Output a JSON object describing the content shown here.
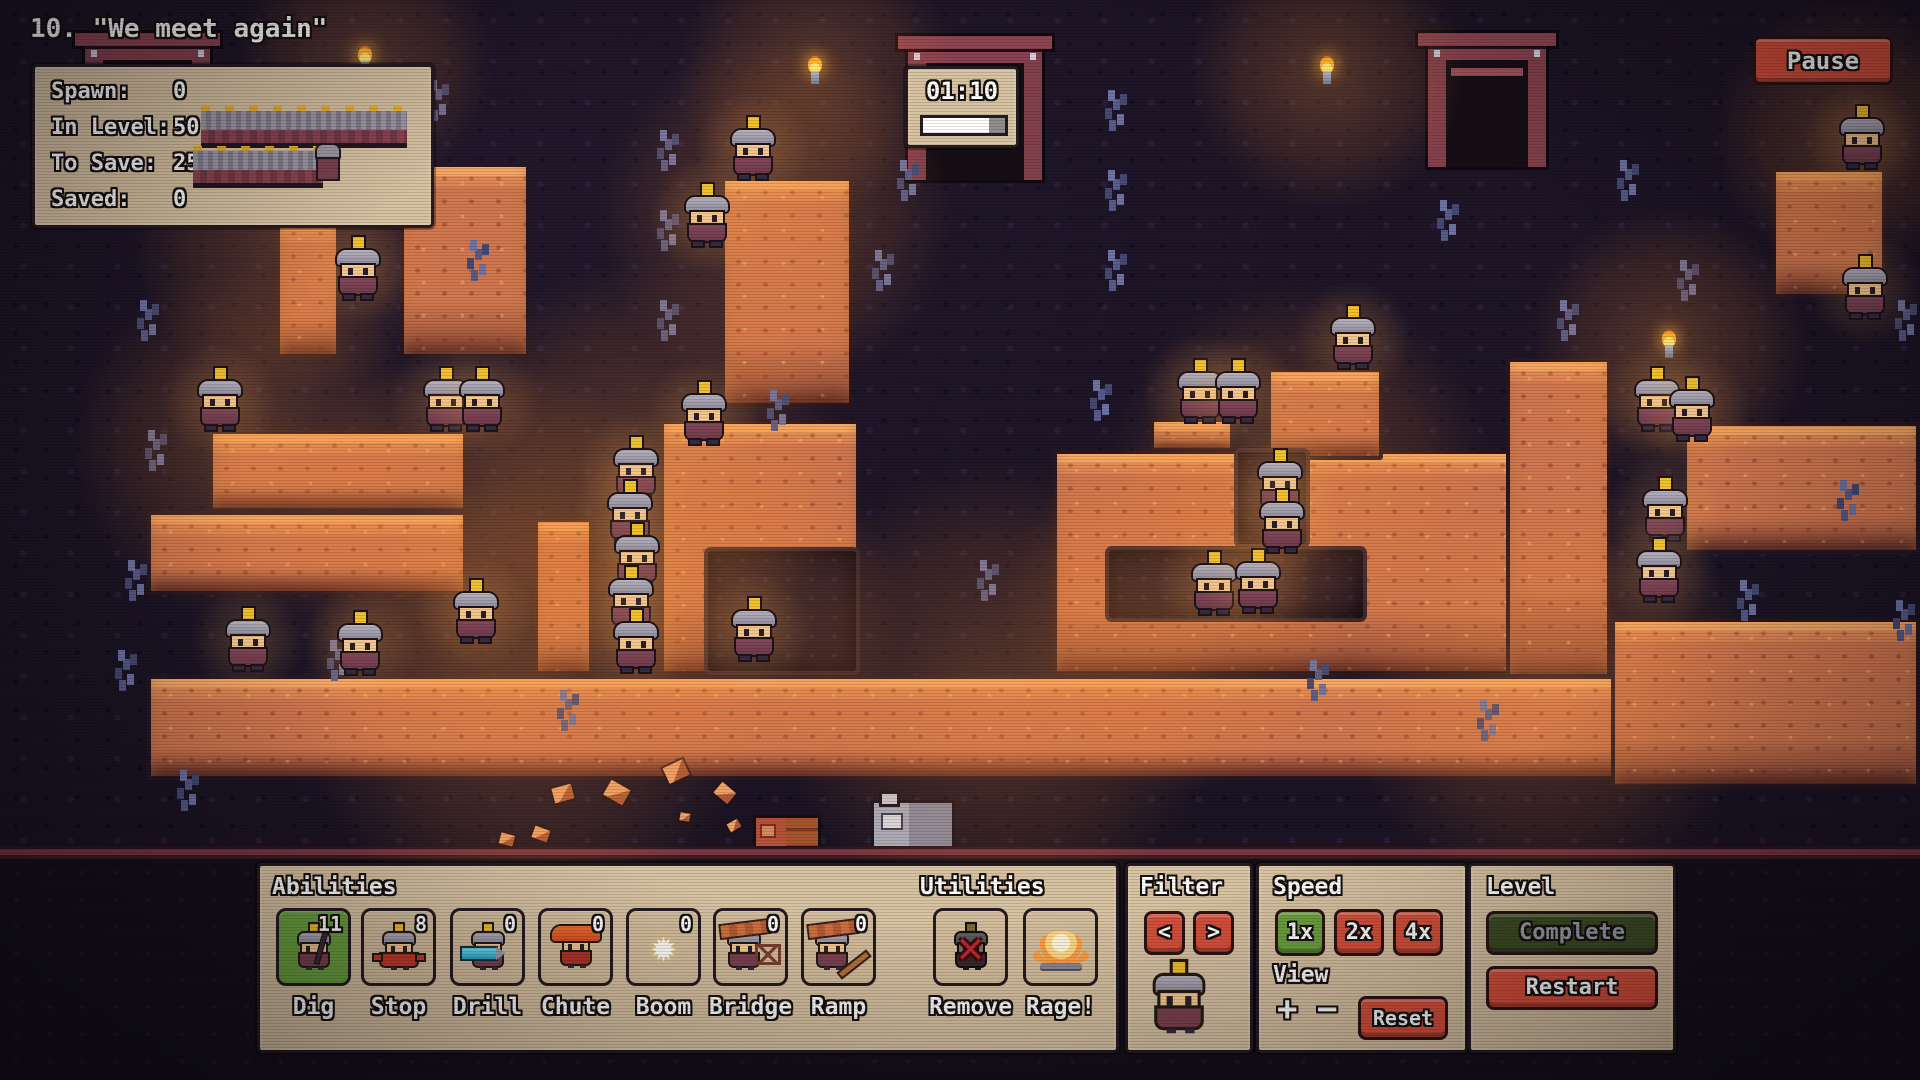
{
  "hud": {
    "title": "10. \"We meet again\"",
    "stats": {
      "rows": [
        {
          "label": "Spawn:",
          "value": "0"
        },
        {
          "label": "In Level:",
          "value": "50"
        },
        {
          "label": "To Save:",
          "value": "25"
        },
        {
          "label": "Saved:",
          "value": "0"
        }
      ]
    },
    "timer": {
      "time": "01:10",
      "progress_percent": 80
    },
    "pause_label": "Pause"
  },
  "icons": {
    "boom_star": "✹",
    "remove_x": "✕",
    "zoom_in": "+",
    "zoom_out": "−",
    "filter_prev": "<",
    "filter_next": ">"
  },
  "toolbar": {
    "abilities": {
      "header": "Abilities",
      "buttons": [
        {
          "label": "Dig",
          "count": "11",
          "selected": true
        },
        {
          "label": "Stop",
          "count": "8",
          "selected": false
        },
        {
          "label": "Drill",
          "count": "0",
          "selected": false
        },
        {
          "label": "Chute",
          "count": "0",
          "selected": false
        },
        {
          "label": "Boom",
          "count": "0",
          "selected": false
        },
        {
          "label": "Bridge",
          "count": "0",
          "selected": false
        },
        {
          "label": "Ramp",
          "count": "0",
          "selected": false
        }
      ]
    },
    "utilities": {
      "header": "Utilities",
      "buttons": [
        {
          "label": "Remove"
        },
        {
          "label": "Rage!"
        }
      ]
    },
    "filter": {
      "header": "Filter"
    },
    "speed": {
      "header": "Speed",
      "options": [
        {
          "label": "1x",
          "selected": true
        },
        {
          "label": "2x",
          "selected": false
        },
        {
          "label": "4x",
          "selected": false
        }
      ],
      "view_header": "View",
      "reset": "Reset"
    },
    "level": {
      "header": "Level",
      "complete": "Complete",
      "restart": "Restart"
    }
  },
  "colors": {
    "panel_tan": "#d7c2a2",
    "button_red": "#d7503b",
    "selected_green": "#6ba13e",
    "complete_green": "#3c4c23",
    "terrain_orange": "#d1774f",
    "cave_dark": "#1a1322",
    "timer_bar_fill": "#ffffff"
  },
  "scene": {
    "terrain": [
      [
        276,
        218,
        64,
        140
      ],
      [
        400,
        163,
        130,
        195
      ],
      [
        721,
        177,
        132,
        230
      ],
      [
        209,
        430,
        258,
        82
      ],
      [
        147,
        511,
        320,
        84
      ],
      [
        534,
        518,
        59,
        157
      ],
      [
        660,
        420,
        200,
        255
      ],
      [
        147,
        675,
        1553,
        105
      ],
      [
        1053,
        450,
        558,
        225
      ],
      [
        1267,
        368,
        116,
        92
      ],
      [
        1150,
        418,
        84,
        34
      ],
      [
        1506,
        358,
        105,
        320
      ],
      [
        1683,
        422,
        237,
        132
      ],
      [
        1611,
        618,
        309,
        170
      ],
      [
        1772,
        168,
        114,
        130
      ]
    ],
    "holes": [
      [
        1234,
        448,
        76,
        100
      ],
      [
        1105,
        546,
        262,
        76
      ],
      [
        704,
        547,
        156,
        128
      ]
    ],
    "miners": [
      [
        334,
        237
      ],
      [
        683,
        184
      ],
      [
        729,
        117
      ],
      [
        196,
        368
      ],
      [
        422,
        368
      ],
      [
        458,
        368
      ],
      [
        680,
        382
      ],
      [
        612,
        437
      ],
      [
        606,
        481
      ],
      [
        613,
        524
      ],
      [
        607,
        567
      ],
      [
        612,
        610
      ],
      [
        730,
        598
      ],
      [
        224,
        608
      ],
      [
        336,
        612
      ],
      [
        452,
        580
      ],
      [
        1190,
        552
      ],
      [
        1234,
        550
      ],
      [
        1176,
        360
      ],
      [
        1214,
        360
      ],
      [
        1329,
        306
      ],
      [
        1256,
        450
      ],
      [
        1258,
        490
      ],
      [
        1633,
        368
      ],
      [
        1668,
        378
      ],
      [
        1641,
        478
      ],
      [
        1635,
        539
      ],
      [
        1838,
        106
      ],
      [
        1841,
        256
      ]
    ],
    "torches": [
      [
        358,
        46
      ],
      [
        808,
        56
      ],
      [
        1320,
        56
      ],
      [
        1662,
        330
      ]
    ],
    "glows": [
      [
        365,
        62,
        130
      ],
      [
        815,
        72,
        140
      ],
      [
        1328,
        72,
        140
      ],
      [
        1670,
        345,
        140
      ],
      [
        775,
        215,
        180
      ],
      [
        640,
        470,
        210
      ],
      [
        250,
        445,
        180
      ],
      [
        470,
        545,
        200
      ],
      [
        1180,
        615,
        180
      ],
      [
        735,
        615,
        170
      ],
      [
        1850,
        135,
        140
      ],
      [
        1300,
        470,
        190
      ],
      [
        525,
        700,
        230
      ],
      [
        1000,
        690,
        230
      ],
      [
        1550,
        690,
        210
      ],
      [
        290,
        240,
        160
      ]
    ],
    "minerals": [
      [
        140,
        300
      ],
      [
        148,
        430
      ],
      [
        128,
        560
      ],
      [
        118,
        650
      ],
      [
        240,
        90
      ],
      [
        430,
        80
      ],
      [
        660,
        130
      ],
      [
        660,
        210
      ],
      [
        660,
        300
      ],
      [
        875,
        250
      ],
      [
        1108,
        90
      ],
      [
        1108,
        170
      ],
      [
        1108,
        250
      ],
      [
        1440,
        200
      ],
      [
        1560,
        300
      ],
      [
        1620,
        160
      ],
      [
        1680,
        260
      ],
      [
        1740,
        580
      ],
      [
        1898,
        300
      ],
      [
        1896,
        600
      ],
      [
        560,
        690
      ],
      [
        980,
        560
      ],
      [
        1310,
        660
      ],
      [
        180,
        770
      ],
      [
        1093,
        380
      ],
      [
        770,
        390
      ],
      [
        470,
        240
      ],
      [
        1840,
        480
      ],
      [
        90,
        180
      ],
      [
        330,
        640
      ],
      [
        1480,
        700
      ],
      [
        900,
        160
      ]
    ],
    "debris": [
      [
        533,
        828,
        16,
        20
      ],
      [
        553,
        786,
        20,
        -15
      ],
      [
        606,
        784,
        22,
        30
      ],
      [
        665,
        763,
        22,
        -25
      ],
      [
        680,
        813,
        10,
        10
      ],
      [
        716,
        786,
        18,
        40
      ],
      [
        728,
        821,
        12,
        -30
      ],
      [
        500,
        834,
        14,
        15
      ]
    ],
    "doors": [
      [
        85,
        45,
        125,
        172
      ],
      [
        908,
        48,
        134,
        132
      ],
      [
        1428,
        45,
        118,
        122
      ]
    ],
    "props": {
      "crate": [
        753,
        815,
        68,
        40
      ],
      "furnace": [
        871,
        800,
        84,
        55
      ]
    }
  }
}
